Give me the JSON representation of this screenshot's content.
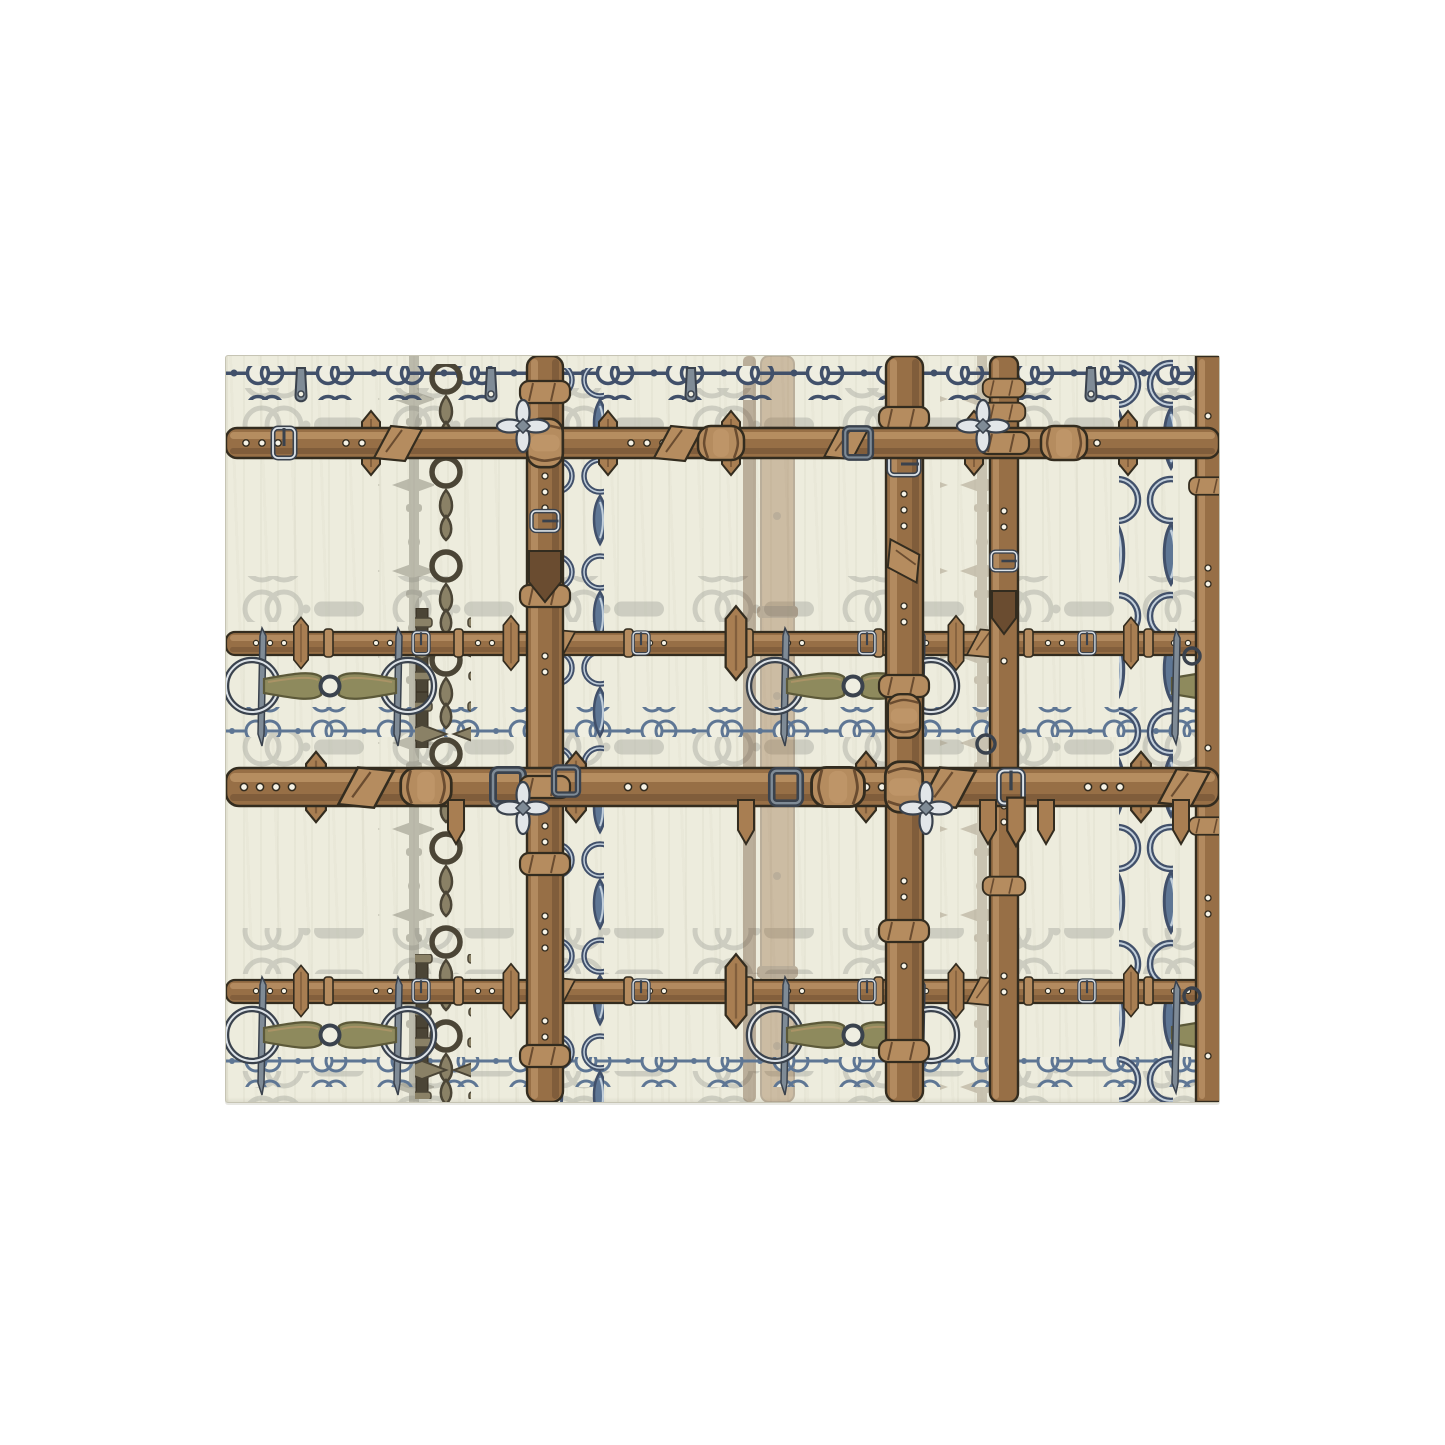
{
  "scene": {
    "type": "product-photo-mockup",
    "subject": "area rug with equestrian bit-and-belt plaid pattern",
    "background": "plain white page, rug centered horizontally, upper-middle vertically"
  },
  "rug": {
    "left_px": 225,
    "top_px": 355,
    "width_px": 993,
    "height_px": 746,
    "base_color": "#edecdd",
    "pattern_description": "plaid/tartan grid built from horizontal and vertical leather belts, steel snaffle-bit chains, blue-gray ring chains, faded ghost ring chains and studded straps, olive horse-bit mouthpieces, silver buckles and clover-shaped connectors"
  },
  "pattern_elements": [
    "horizontal-leather-belt",
    "vertical-leather-belt",
    "thin-leather-belt",
    "snaffle-bit-olive",
    "dark-ring-teardrop-chain",
    "blue-ring-chain",
    "navy-link-chain-row",
    "ghost-ring-chain-row",
    "ghost-studded-strap",
    "silver-clover-connector",
    "metal-buckle",
    "keeper-tab",
    "hanging-strap-hook"
  ],
  "colors": {
    "page_bg": "#ffffff",
    "rug_bg": "#edecdd",
    "rug_streak": "#e2e0ce",
    "rug_edge": "#c6c4b4",
    "outline": "#332c1f",
    "leather_mid": "#976f46",
    "leather_hi": "#c59c6f",
    "leather_lo": "#6a4c30",
    "leather_pale": "#b58c5f",
    "tab": "#a87e52",
    "metal_dark": "#3a424d",
    "metal_mid": "#7f8b96",
    "metal_hi": "#dde3e8",
    "navy": "#41506a",
    "steel": "#5e7694",
    "steel_hi": "#c2cfdb",
    "ring_fill": "#efeee1",
    "ghost": "#b5b7ac",
    "ghost_dark": "#8b897b",
    "ghost_tan": "#a59a85",
    "olive": "#8e8a5d",
    "olive_lo": "#5c5939",
    "darkchain": "#4b4536",
    "darkchain_hi": "#8a8166",
    "silver_hi": "#e2e6e9"
  }
}
